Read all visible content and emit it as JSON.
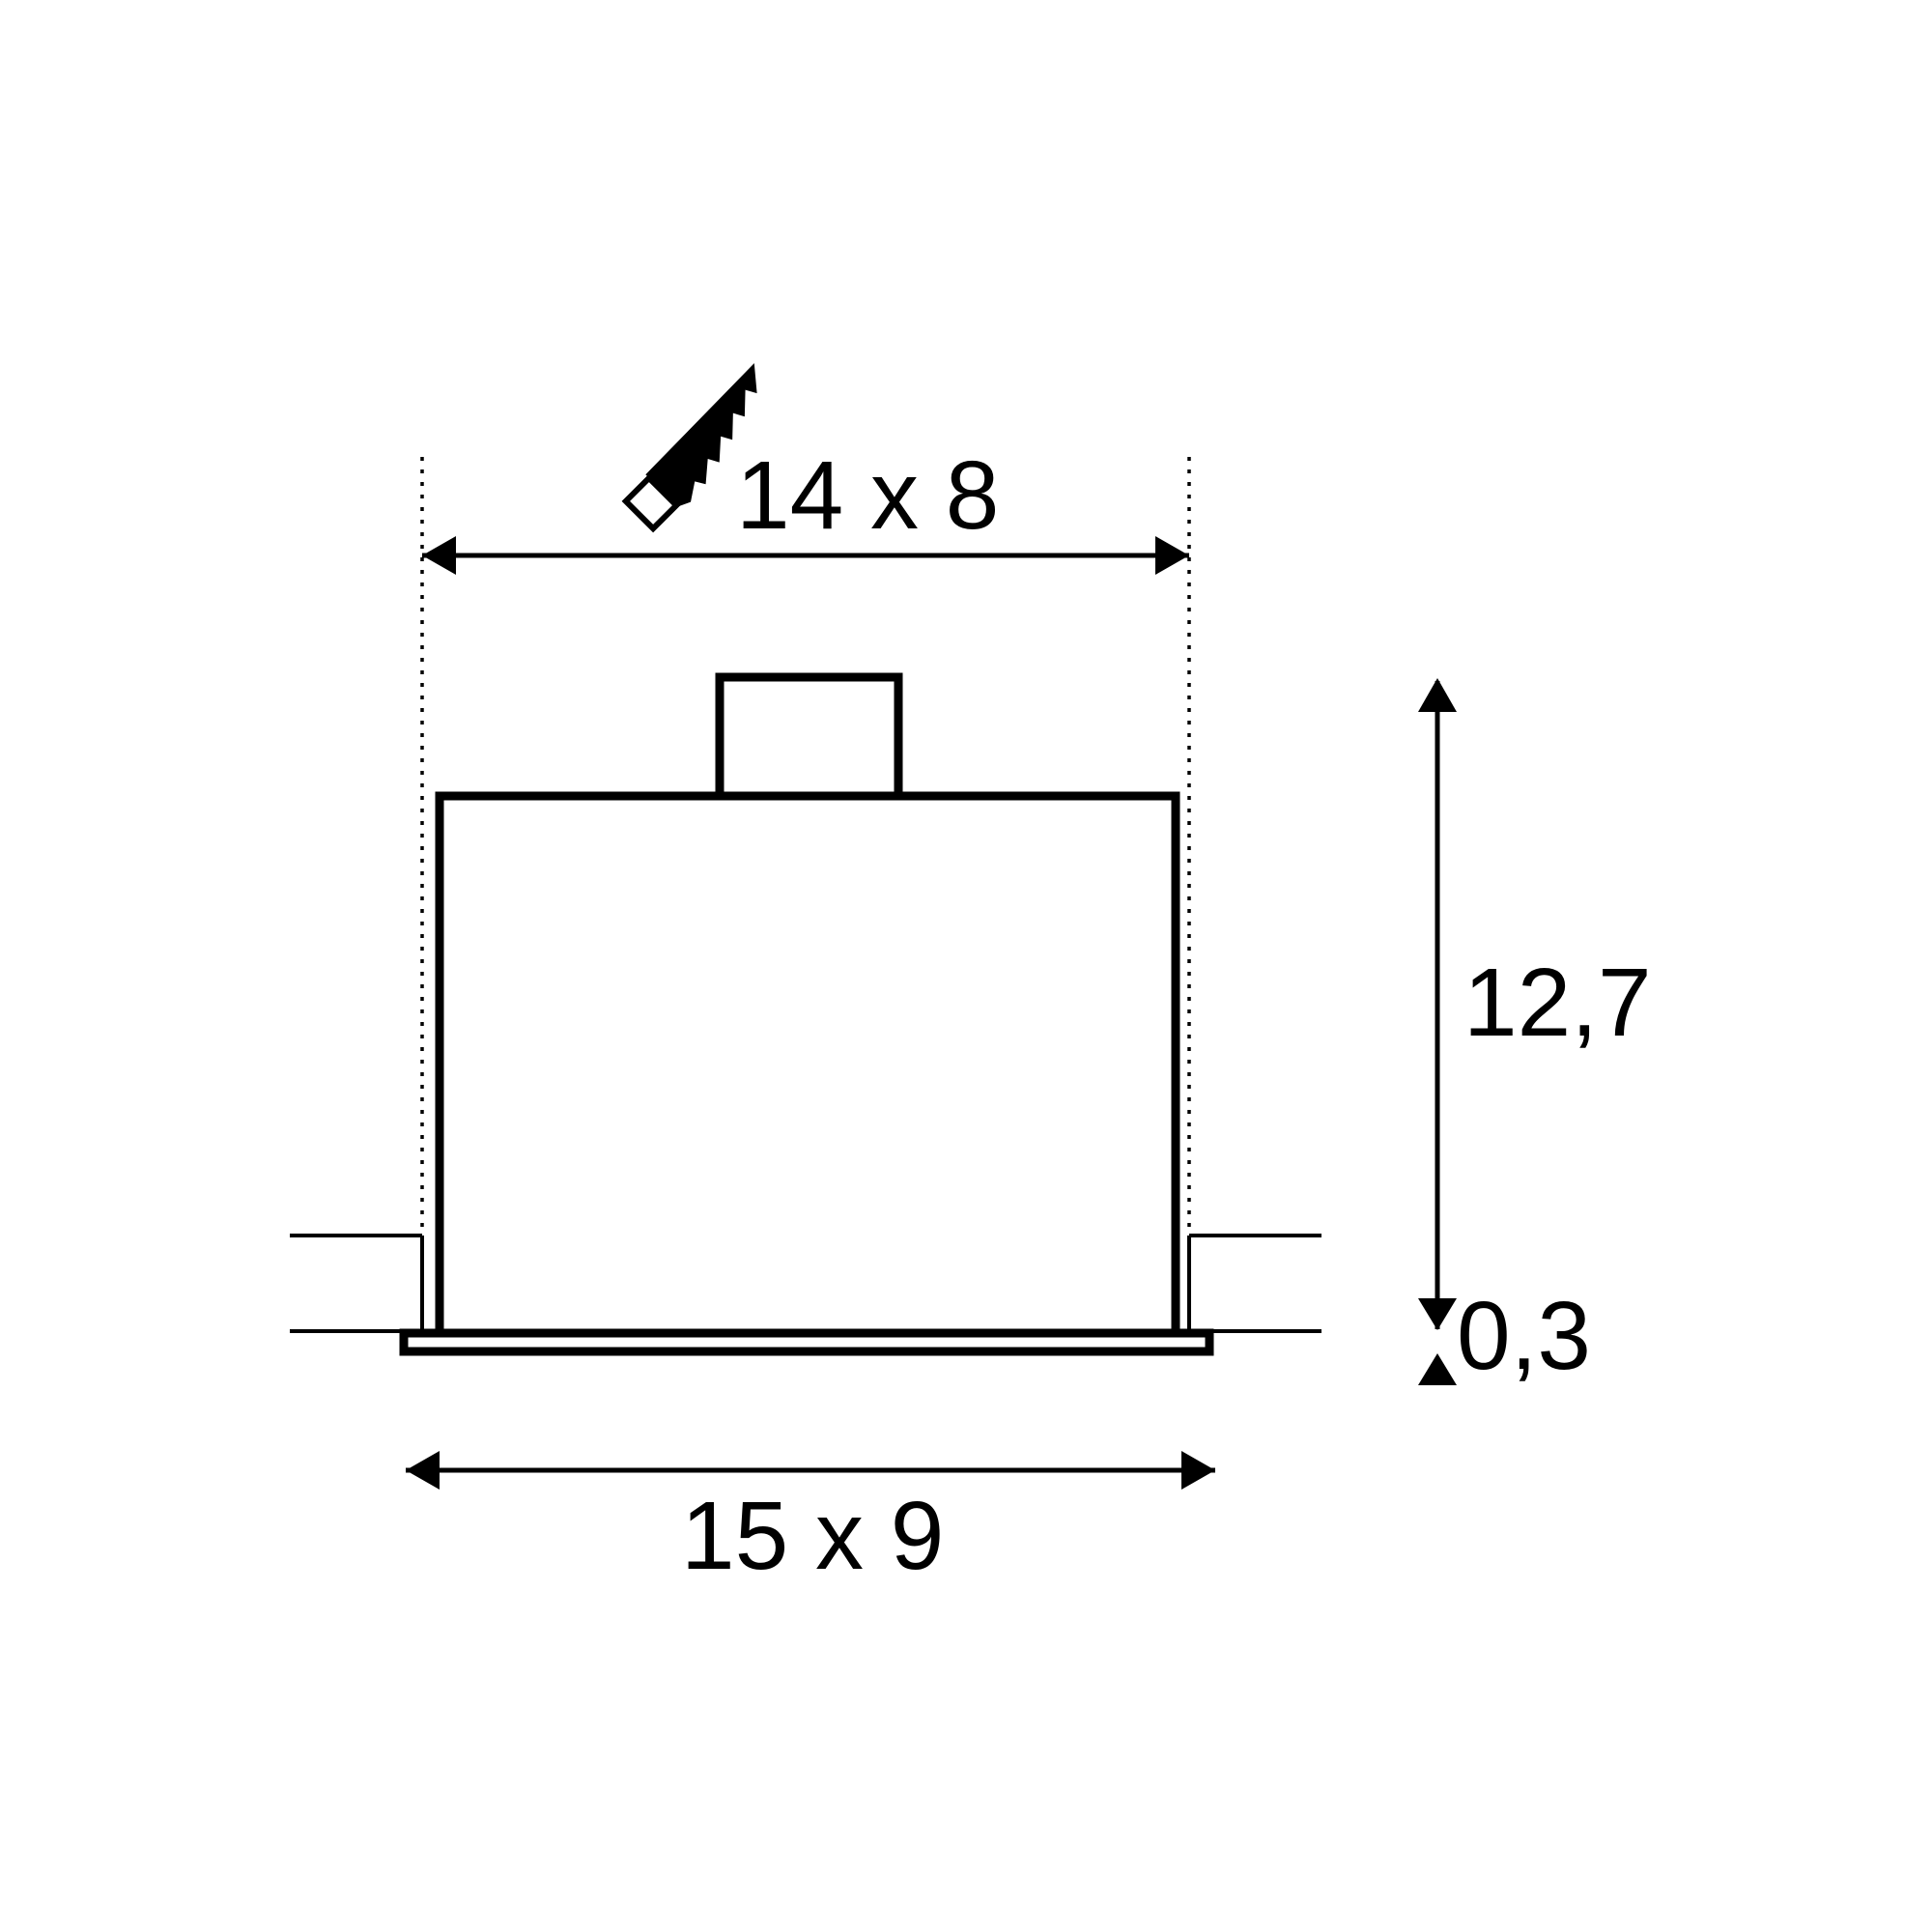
{
  "drawing": {
    "description": "Installation dimension drawing of a recessed ceiling luminaire, front cross-section",
    "background_color": "#ffffff",
    "line_color": "#000000",
    "labels": {
      "cutout_size": "14 x 8",
      "recess_depth": "12,7",
      "flange_thickness": "0,3",
      "outer_size": "15 x 9"
    },
    "icons": {
      "saw": "handsaw-icon"
    }
  }
}
